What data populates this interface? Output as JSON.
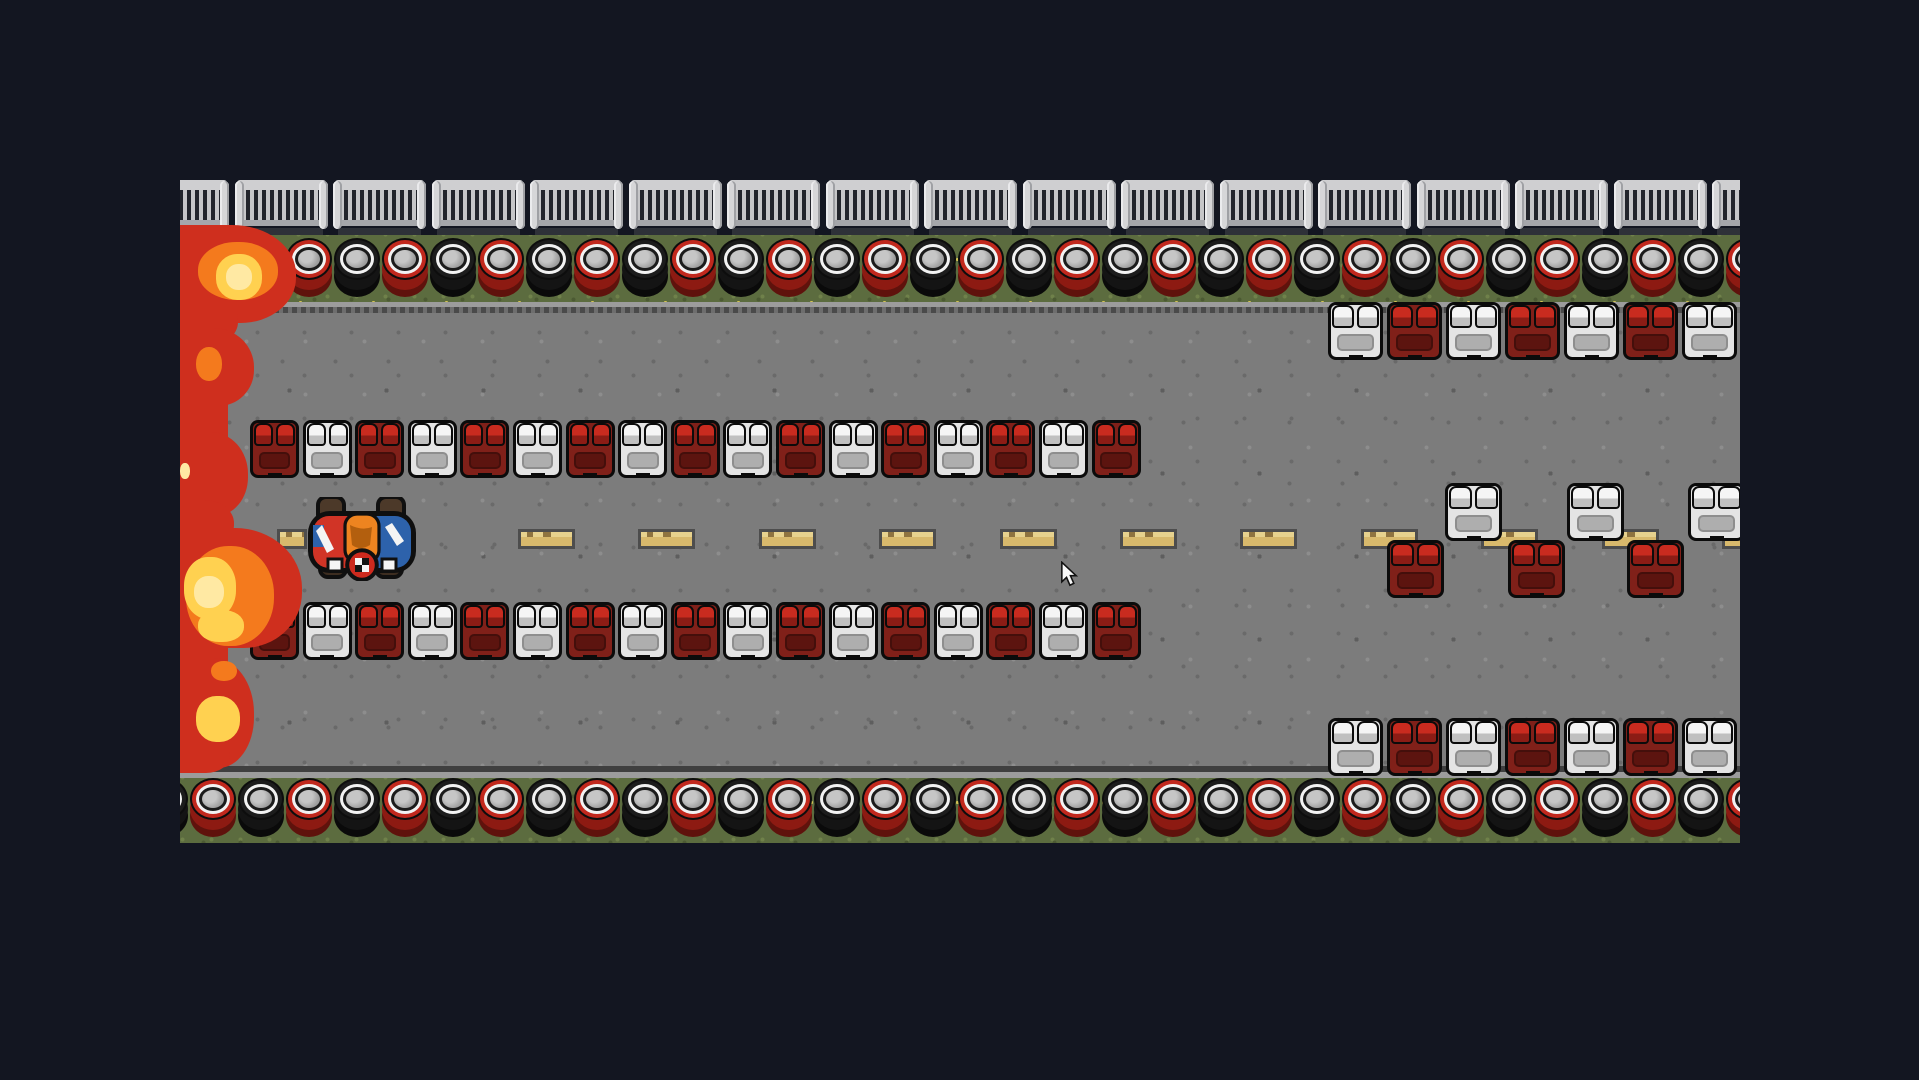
{
  "scene": {
    "background": "#131621",
    "board": {
      "x": 180,
      "y": 180,
      "w": 1560,
      "h": 663
    },
    "bands": {
      "fence_h": 55,
      "grass_top": {
        "y": 55,
        "h": 67
      },
      "road": {
        "y": 122,
        "h": 476
      },
      "grass_bottom": {
        "y": 598,
        "h": 65
      }
    }
  },
  "fence": {
    "y": 0,
    "start_x": -44,
    "period": 98.5,
    "count": 17,
    "w": 93
  },
  "tire_rows": [
    {
      "name": "tire-wall-top",
      "y": 58,
      "start_x": -39,
      "period": 48,
      "count": 34,
      "colors": [
        "black",
        "red"
      ]
    },
    {
      "name": "tire-wall-bottom",
      "y": 598,
      "start_x": -39,
      "period": 48,
      "count": 34,
      "colors": [
        "black",
        "red"
      ]
    }
  ],
  "block_rows": [
    {
      "name": "barrier-row-mid-upper",
      "x": 70,
      "y": 240,
      "block_w": 49,
      "gap": 3.6,
      "pattern": [
        "red",
        "white",
        "red",
        "white",
        "red",
        "white",
        "red",
        "white",
        "red",
        "white",
        "red",
        "white",
        "red",
        "white",
        "red",
        "white",
        "red"
      ]
    },
    {
      "name": "barrier-row-mid-lower",
      "x": 70,
      "y": 422,
      "block_w": 49,
      "gap": 3.6,
      "pattern": [
        "red",
        "white",
        "red",
        "white",
        "red",
        "white",
        "red",
        "white",
        "red",
        "white",
        "red",
        "white",
        "red",
        "white",
        "red",
        "white",
        "red"
      ]
    },
    {
      "name": "barrier-row-right-upper",
      "x": 1148,
      "y": 122,
      "block_w": 55,
      "gap": 4,
      "pattern": [
        "white",
        "red",
        "white",
        "red",
        "white",
        "red",
        "white"
      ]
    },
    {
      "name": "barrier-row-right-lower",
      "x": 1148,
      "y": 538,
      "block_w": 55,
      "gap": 4,
      "pattern": [
        "white",
        "red",
        "white",
        "red",
        "white",
        "red",
        "white"
      ]
    }
  ],
  "scattered_blocks": [
    {
      "x": 1265,
      "y": 303,
      "w": 57,
      "color": "white"
    },
    {
      "x": 1387,
      "y": 303,
      "w": 57,
      "color": "white"
    },
    {
      "x": 1508,
      "y": 303,
      "w": 57,
      "color": "white"
    },
    {
      "x": 1207,
      "y": 360,
      "w": 57,
      "color": "red"
    },
    {
      "x": 1328,
      "y": 360,
      "w": 57,
      "color": "red"
    },
    {
      "x": 1447,
      "y": 360,
      "w": 57,
      "color": "red"
    }
  ],
  "center_line": {
    "y": 349,
    "dash_h": 20,
    "dashes": [
      {
        "x": 97,
        "w": 30
      },
      {
        "x": 338,
        "w": 57
      },
      {
        "x": 458,
        "w": 57
      },
      {
        "x": 579,
        "w": 57
      },
      {
        "x": 699,
        "w": 57
      },
      {
        "x": 820,
        "w": 57
      },
      {
        "x": 940,
        "w": 57
      },
      {
        "x": 1060,
        "w": 57
      },
      {
        "x": 1181,
        "w": 57
      },
      {
        "x": 1301,
        "w": 57
      },
      {
        "x": 1422,
        "w": 57
      },
      {
        "x": 1542,
        "w": 57
      }
    ]
  },
  "lava": {
    "column": {
      "x": 0,
      "y": 50,
      "w": 48,
      "h": 535
    },
    "blobs": [
      {
        "c": "red",
        "x": 0,
        "y": 45,
        "w": 116,
        "h": 98
      },
      {
        "c": "red",
        "x": 0,
        "y": 115,
        "w": 58,
        "h": 50
      },
      {
        "c": "red",
        "x": 0,
        "y": 148,
        "w": 74,
        "h": 78
      },
      {
        "c": "red",
        "x": 0,
        "y": 252,
        "w": 68,
        "h": 84
      },
      {
        "c": "red",
        "x": 0,
        "y": 320,
        "w": 54,
        "h": 46
      },
      {
        "c": "red",
        "x": 0,
        "y": 348,
        "w": 122,
        "h": 120
      },
      {
        "c": "red",
        "x": 0,
        "y": 478,
        "w": 74,
        "h": 110
      },
      {
        "c": "red",
        "x": 0,
        "y": 555,
        "w": 50,
        "h": 38
      },
      {
        "c": "orange",
        "x": 18,
        "y": 62,
        "w": 80,
        "h": 58
      },
      {
        "c": "orange",
        "x": 16,
        "y": 167,
        "w": 26,
        "h": 34
      },
      {
        "c": "orange",
        "x": 6,
        "y": 366,
        "w": 88,
        "h": 100
      },
      {
        "c": "orange",
        "x": 31,
        "y": 481,
        "w": 26,
        "h": 20
      },
      {
        "c": "yellow",
        "x": 36,
        "y": 74,
        "w": 46,
        "h": 46
      },
      {
        "c": "yellow",
        "x": 4,
        "y": 377,
        "w": 52,
        "h": 62
      },
      {
        "c": "yellow",
        "x": 18,
        "y": 430,
        "w": 46,
        "h": 32
      },
      {
        "c": "yellow",
        "x": 16,
        "y": 516,
        "w": 44,
        "h": 46
      },
      {
        "c": "pale",
        "x": 46,
        "y": 84,
        "w": 26,
        "h": 26
      },
      {
        "c": "pale",
        "x": 0,
        "y": 283,
        "w": 10,
        "h": 16
      },
      {
        "c": "pale",
        "x": 14,
        "y": 396,
        "w": 30,
        "h": 32
      }
    ]
  },
  "kart": {
    "x": 124,
    "y": 317,
    "w": 116,
    "h": 84,
    "colors": {
      "body_left": "#d13426",
      "body_right": "#2d62ab",
      "driver": "#ee8420",
      "driver_shade": "#b35f0e",
      "wheel": "#4c3929",
      "emblem": "#ce2a1e"
    }
  },
  "cursor": {
    "x": 880,
    "y": 381
  }
}
